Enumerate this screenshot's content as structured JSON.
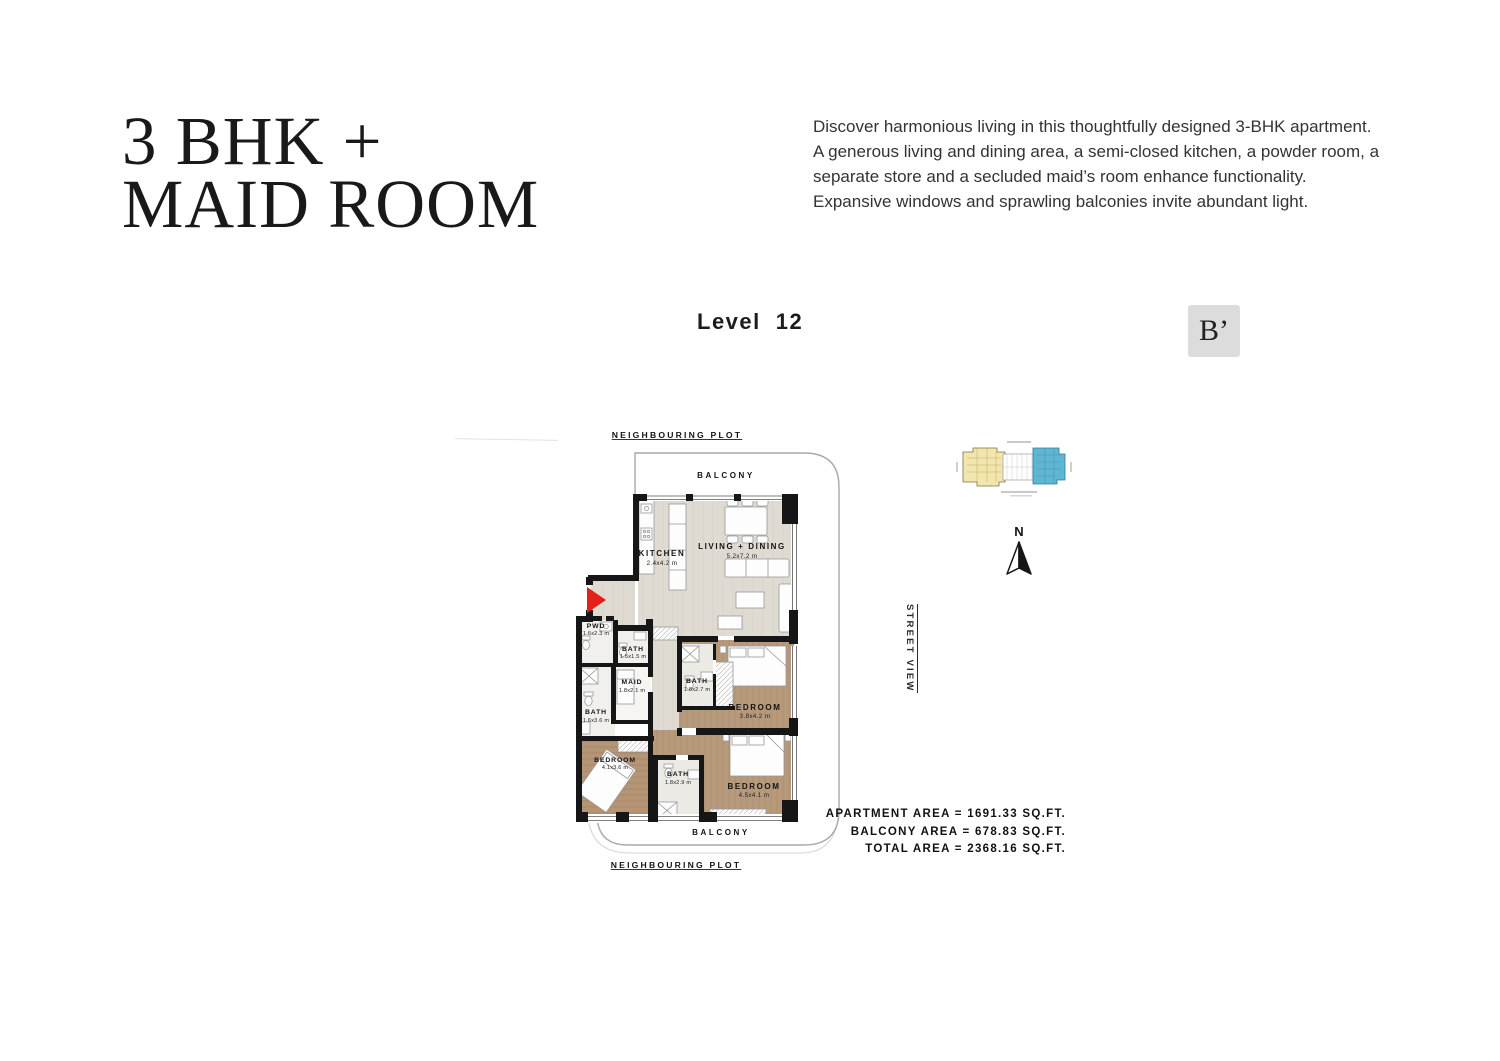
{
  "page": {
    "title_line1": "3 BHK +",
    "title_line2": "MAID ROOM",
    "description_lines": [
      "Discover harmonious living in this thoughtfully designed 3-BHK apartment.",
      "A generous living and dining area, a semi-closed kitchen, a powder room, a",
      "separate store and a secluded maid’s room enhance functionality.",
      "Expansive windows and sprawling balconies invite abundant light."
    ],
    "level_label": "Level",
    "level_number": "12",
    "section_badge": "B’"
  },
  "plan": {
    "neighbouring_plot_top": "NEIGHBOURING PLOT",
    "neighbouring_plot_bottom": "NEIGHBOURING PLOT",
    "balcony_top": "BALCONY",
    "balcony_bottom": "BALCONY",
    "street_view_label": "STREET VIEW",
    "north_label": "N",
    "rooms": {
      "kitchen": {
        "name": "KITCHEN",
        "dim": "2.4x4.2 m"
      },
      "living_dining": {
        "name": "LIVING + DINING",
        "dim": "5.2x7.2 m"
      },
      "pwd": {
        "name": "PWD",
        "dim": "1.6x2.3 m"
      },
      "bath_small": {
        "name": "BATH",
        "dim": "1.5x1.5 m"
      },
      "maid": {
        "name": "MAID",
        "dim": "1.8x2.1 m"
      },
      "bath_left": {
        "name": "BATH",
        "dim": "1.6x3.6 m"
      },
      "bath_mid": {
        "name": "BATH",
        "dim": "1.8x2.7 m"
      },
      "bedroom_mid": {
        "name": "BEDROOM",
        "dim": "3.8x4.2 m"
      },
      "bedroom_left": {
        "name": "BEDROOM",
        "dim": "4.1x3.6 m"
      },
      "bath_bottom": {
        "name": "BATH",
        "dim": "1.8x2.9 m"
      },
      "bedroom_right": {
        "name": "BEDROOM",
        "dim": "4.5x4.1 m"
      }
    }
  },
  "areas": {
    "apartment": "APARTMENT AREA = 1691.33 SQ.FT.",
    "balcony": "BALCONY AREA = 678.83 SQ.FT.",
    "total": "TOTAL AREA = 2368.16 SQ.FT."
  },
  "colors": {
    "badge_bg": "#dcdcdc",
    "entry_arrow_red": "#e32119",
    "keyplan_wing_yellow": "#f2e5ad",
    "keyplan_highlight_blue": "#5fb6d2",
    "wood_floor": "#b79a7c",
    "tile_floor": "#dfdbd3",
    "wall": "#161616"
  }
}
